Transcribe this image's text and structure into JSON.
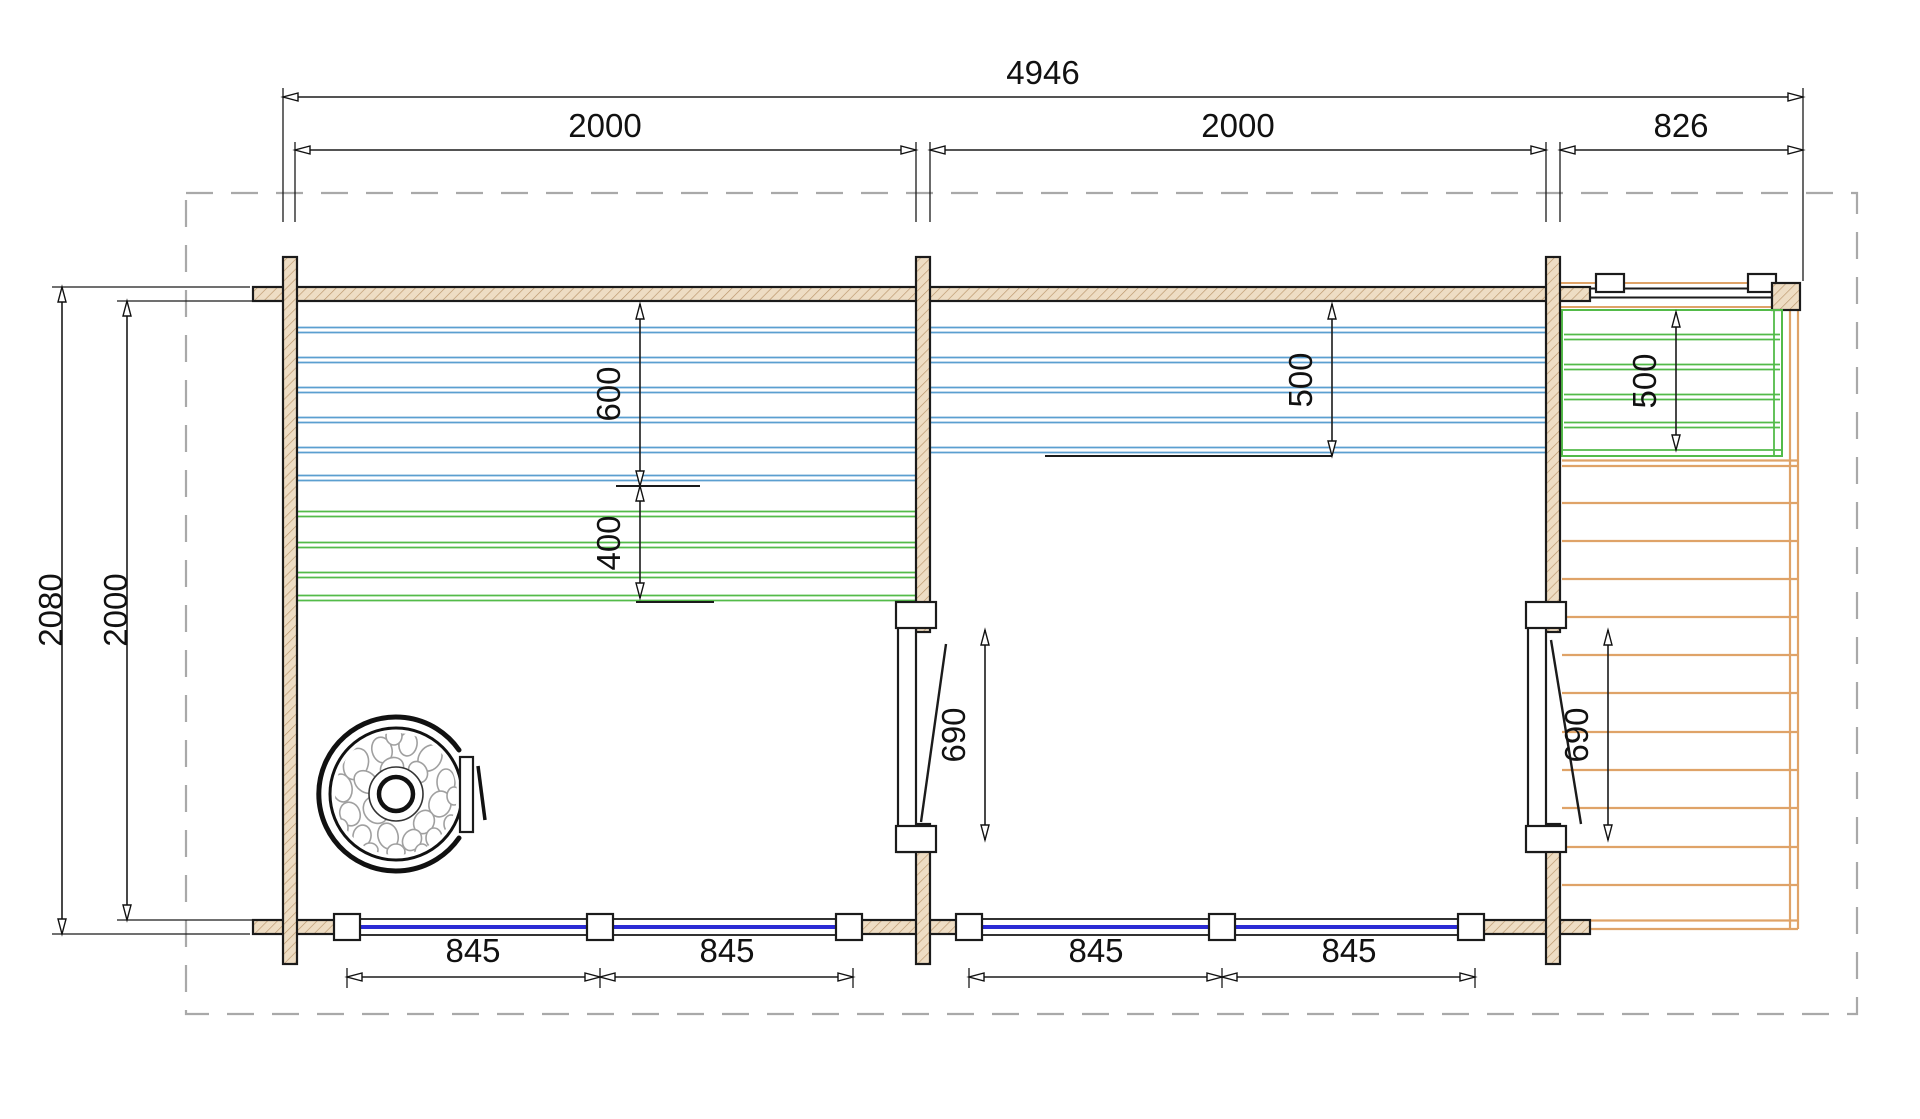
{
  "drawing": {
    "type": "log-cabin sauna floor plan with terrace",
    "dims": {
      "total_width": "4946",
      "left_room_width": "2000",
      "middle_room_width": "2000",
      "terrace_width": "826",
      "total_depth": "2080",
      "inner_depth": "2000",
      "sauna_bench_upper": "600",
      "sauna_bench_lower": "400",
      "middle_bench_depth": "500",
      "terrace_bench_depth": "500",
      "middle_door_width": "690",
      "terrace_door_width": "690",
      "window_left_1": "845",
      "window_left_2": "845",
      "window_middle_1": "845",
      "window_middle_2": "845"
    },
    "colors": {
      "wall_fill": "#eeddc4",
      "wall_hatch": "#b99469",
      "bench_blue": "#5b9fd0",
      "bench_green": "#53bb49",
      "deck_orange": "#dfa368",
      "window_glass_blue": "#2b2bd5",
      "boundary_dash_gray": "#a9a9a9",
      "line_black": "#1b1b1b"
    }
  }
}
